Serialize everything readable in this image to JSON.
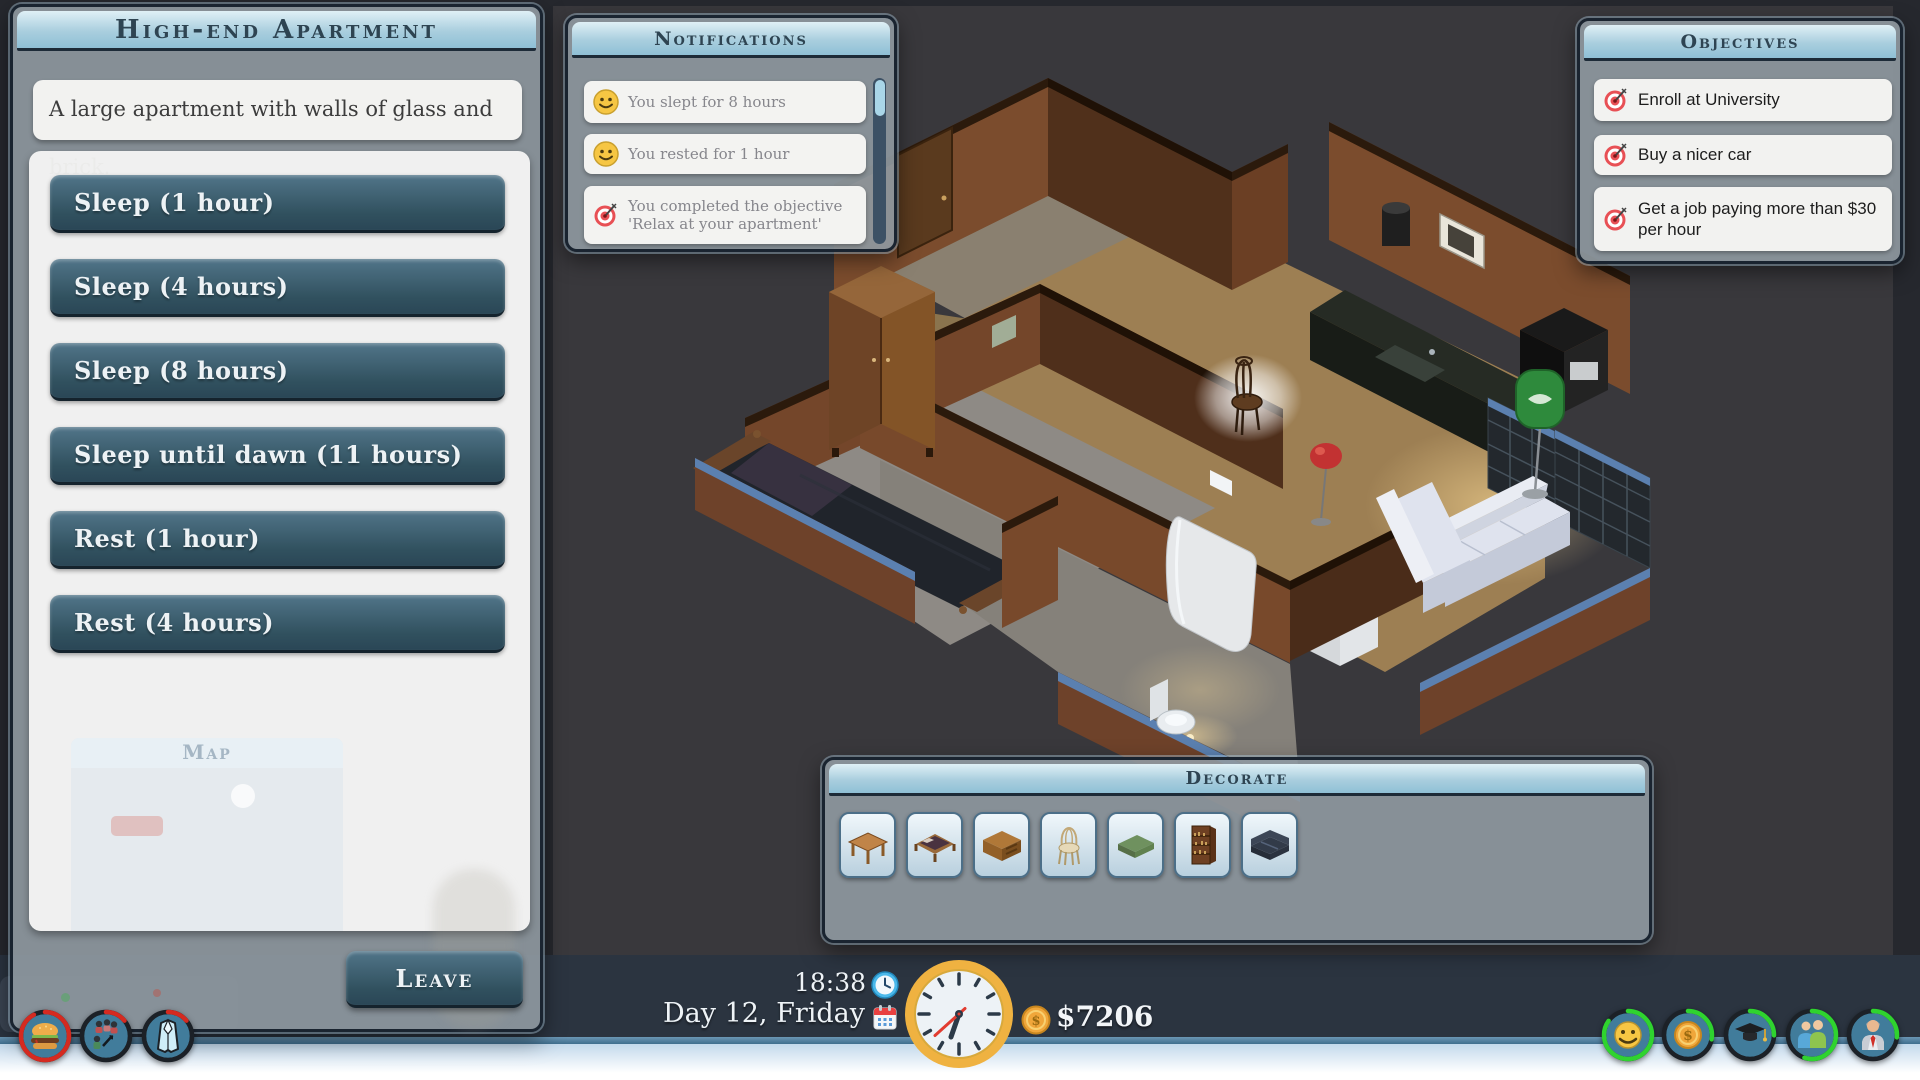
{
  "left_panel": {
    "title": "High-end Apartment",
    "description": "A large apartment with walls of glass and brick.",
    "actions": [
      {
        "label": "Sleep (1 hour)"
      },
      {
        "label": "Sleep (4 hours)"
      },
      {
        "label": "Sleep (8 hours)"
      },
      {
        "label": "Sleep until dawn (11 hours)"
      },
      {
        "label": "Rest (1 hour)"
      },
      {
        "label": "Rest (4 hours)"
      }
    ],
    "leave_label": "Leave",
    "background_window_title": "Map"
  },
  "notifications": {
    "title": "Notifications",
    "items": [
      {
        "icon": "smiley-icon",
        "text": "You slept for 8 hours"
      },
      {
        "icon": "smiley-icon",
        "text": "You rested for 1 hour"
      },
      {
        "icon": "objective-target-icon",
        "text": "You completed the objective 'Relax at your apartment'"
      }
    ]
  },
  "objectives": {
    "title": "Objectives",
    "items": [
      {
        "icon": "objective-target-icon",
        "text": "Enroll at University"
      },
      {
        "icon": "objective-target-icon",
        "text": "Buy a nicer car"
      },
      {
        "icon": "objective-target-icon",
        "text": "Get a job paying more than $30 per hour"
      }
    ]
  },
  "decorate": {
    "title": "Decorate",
    "items": [
      {
        "name": "table"
      },
      {
        "name": "bed"
      },
      {
        "name": "desk"
      },
      {
        "name": "chair"
      },
      {
        "name": "mattress"
      },
      {
        "name": "bookcase"
      },
      {
        "name": "sofa"
      }
    ]
  },
  "hud": {
    "time": "18:38",
    "date": "Day 12, Friday",
    "money": "$7206",
    "currency_symbol": "$"
  },
  "stats": {
    "hunger": {
      "icon": "burger-icon",
      "ring_color": "#d42a20",
      "dash": "139 151"
    },
    "social": {
      "icon": "people-arrows-icon",
      "ring_color": "#d42a20",
      "dash": "21 151"
    },
    "style": {
      "icon": "jacket-icon",
      "ring_color": "#d42a20",
      "dash": "21 151"
    },
    "happiness": {
      "icon": "smiley-icon",
      "ring_color": "#2fd32f",
      "dash": "128 151"
    },
    "money": {
      "icon": "coin-icon",
      "ring_color": "#2fd32f",
      "dash": "42 151"
    },
    "education": {
      "icon": "grad-cap-icon",
      "ring_color": "#2fd32f",
      "dash": "38 151"
    },
    "friends": {
      "icon": "two-people-icon",
      "ring_color": "#2fd32f",
      "dash": "83 151"
    },
    "job": {
      "icon": "person-tie-icon",
      "ring_color": "#2fd32f",
      "dash": "40 151"
    }
  },
  "colors": {
    "accent_red": "#d42a20",
    "accent_green": "#2fd32f",
    "trim_blue": "#5b80b0",
    "header_text": "#2e4452"
  }
}
